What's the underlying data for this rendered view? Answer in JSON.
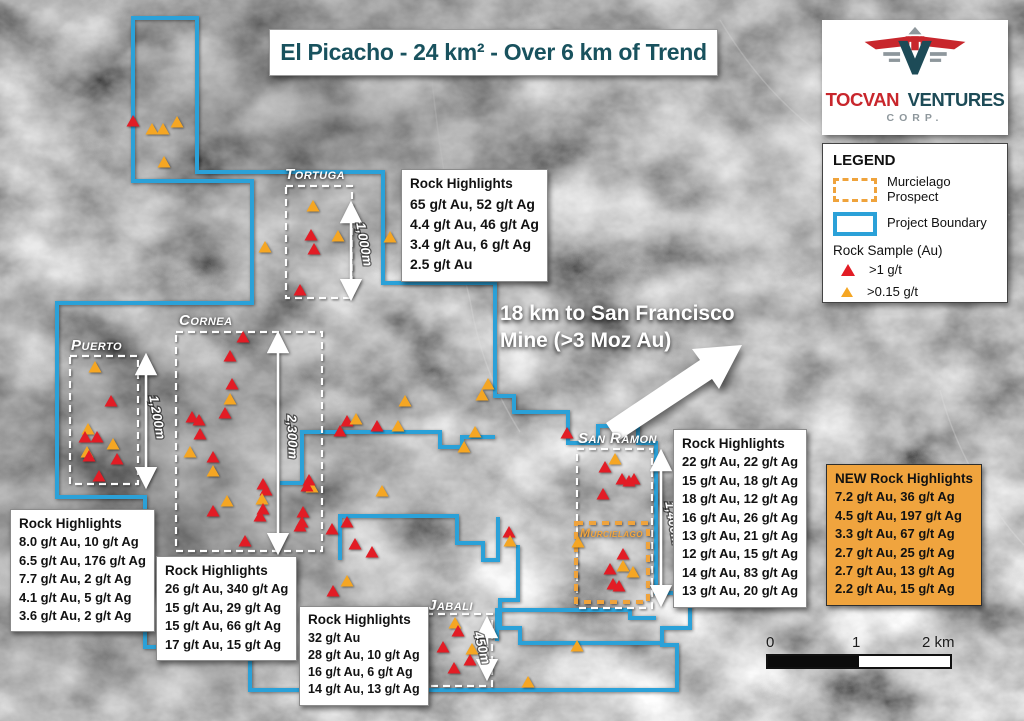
{
  "title": "El Picacho - 24 km² - Over 6 km of Trend",
  "logo": {
    "word1": "TOCVAN",
    "word2": "VENTURES",
    "corp": "CORP."
  },
  "legend": {
    "heading": "LEGEND",
    "murcielago": "Murcielago Prospect",
    "boundary": "Project Boundary",
    "rock_sample": "Rock Sample (Au)",
    "high_grade": ">1 g/t",
    "low_grade": ">0.15 g/t"
  },
  "annotation": {
    "line1": "18 km to San Francisco",
    "line2": "Mine (>3 Moz Au)"
  },
  "scale_bar": {
    "tick0": "0",
    "tick1": "1",
    "tick2": "2 km"
  },
  "zones": {
    "tortuga": {
      "label": "Tortuga",
      "length": "1,000m"
    },
    "cornea": {
      "label": "Cornea",
      "length": "2,300m"
    },
    "puerto": {
      "label": "Puerto",
      "length": "1,200m"
    },
    "san_ramon": {
      "label": "San Ramon",
      "length": "1,400m"
    },
    "murcielago": {
      "label": "Murcielago"
    },
    "jabali": {
      "label": "Jabali",
      "length": "450m"
    }
  },
  "highlights": {
    "tortuga": {
      "title": "Rock Highlights",
      "lines": [
        "65 g/t Au, 52 g/t Ag",
        "4.4 g/t Au, 46 g/t Ag",
        "3.4 g/t Au, 6 g/t Ag",
        "2.5 g/t Au"
      ]
    },
    "puerto": {
      "title": "Rock Highlights",
      "lines": [
        "8.0 g/t Au, 10 g/t Ag",
        "6.5 g/t Au, 176 g/t Ag",
        "7.7 g/t Au, 2 g/t Ag",
        "4.1 g/t Au, 5 g/t Ag",
        "3.6 g/t Au, 2 g/t Ag"
      ]
    },
    "cornea": {
      "title": "Rock Highlights",
      "lines": [
        "26 g/t Au, 340 g/t Ag",
        "15 g/t Au, 29 g/t Ag",
        "15 g/t Au, 66 g/t Ag",
        "17 g/t Au, 15 g/t Ag"
      ]
    },
    "jabali": {
      "title": "Rock Highlights",
      "lines": [
        "32 g/t Au",
        "28 g/t Au, 10 g/t Ag",
        "16 g/t Au, 6 g/t Ag",
        "14 g/t Au, 13 g/t Ag"
      ]
    },
    "san_ramon": {
      "title": "Rock Highlights",
      "lines": [
        "22 g/t Au, 22 g/t Ag",
        "15 g/t Au, 18 g/t Ag",
        "18 g/t Au, 12 g/t Ag",
        "16 g/t Au, 26 g/t Ag",
        "13 g/t Au, 21 g/t Ag",
        "12 g/t Au, 15 g/t Ag",
        "14 g/t Au, 83 g/t Ag",
        "13 g/t Au, 20 g/t Ag"
      ]
    },
    "new": {
      "title": "NEW Rock Highlights",
      "lines": [
        "7.2 g/t Au, 36 g/t Ag",
        "4.5 g/t Au, 197 g/t Ag",
        "3.3 g/t Au, 67 g/t Ag",
        "2.7 g/t Au, 25 g/t Ag",
        "2.7 g/t Au, 13 g/t Ag",
        "2.2 g/t Au, 15 g/t Ag"
      ]
    }
  },
  "map_data": {
    "colors": {
      "boundary": "#2BA1D8",
      "prospect": "#EFA33C",
      "sample_high": "#E21C25",
      "sample_low": "#F5A623",
      "accent_teal": "#19525E",
      "accent_red": "#C8262C",
      "new_box_bg": "#F0A43E"
    },
    "boundary_paths": [
      "M133,18 L197,18 L197,172 L383,172 L383,283 L495,283 L495,396 L514,396 L514,412 L568,412 L568,443 L598,443 L598,426 L638,426 L638,443 L656,443 L656,593 L690,593 L690,628 L662,628 L662,645 L677,645 L677,690 L250,690 L250,647 L145,647 L145,497 L57,497 L57,303 L252,303 L252,181 L133,181 Z",
      "M280,483 L302,483 L302,432 L440,432 L440,447 L462,447 L462,437 L495,437",
      "M340,560 L340,516 L457,516 L457,543 L483,543 L483,560 L498,560 L498,517",
      "M518,545 L518,600 L500,600 L500,628 L520,628 L520,643 L662,643",
      "M497,641 L497,610 L630,610 L630,618 L656,618"
    ],
    "samples": [
      [
        133,
        122,
        "r"
      ],
      [
        152,
        130,
        "o"
      ],
      [
        163,
        130,
        "o"
      ],
      [
        177,
        123,
        "o"
      ],
      [
        164,
        163,
        "o"
      ],
      [
        265,
        248,
        "o"
      ],
      [
        313,
        207,
        "o"
      ],
      [
        311,
        236,
        "r"
      ],
      [
        314,
        250,
        "r"
      ],
      [
        338,
        237,
        "o"
      ],
      [
        300,
        291,
        "r"
      ],
      [
        390,
        238,
        "o"
      ],
      [
        488,
        385,
        "o"
      ],
      [
        482,
        396,
        "o"
      ],
      [
        405,
        402,
        "o"
      ],
      [
        347,
        422,
        "r"
      ],
      [
        356,
        420,
        "o"
      ],
      [
        377,
        427,
        "r"
      ],
      [
        398,
        427,
        "o"
      ],
      [
        340,
        432,
        "r"
      ],
      [
        475,
        433,
        "o"
      ],
      [
        464,
        448,
        "o"
      ],
      [
        567,
        434,
        "r"
      ],
      [
        95,
        368,
        "o"
      ],
      [
        111,
        402,
        "r"
      ],
      [
        88,
        430,
        "o"
      ],
      [
        85,
        438,
        "r"
      ],
      [
        97,
        438,
        "r"
      ],
      [
        113,
        445,
        "o"
      ],
      [
        87,
        453,
        "o"
      ],
      [
        89,
        457,
        "r"
      ],
      [
        117,
        460,
        "r"
      ],
      [
        99,
        477,
        "r"
      ],
      [
        243,
        338,
        "r"
      ],
      [
        230,
        357,
        "r"
      ],
      [
        232,
        385,
        "r"
      ],
      [
        230,
        400,
        "o"
      ],
      [
        225,
        414,
        "r"
      ],
      [
        192,
        418,
        "r"
      ],
      [
        199,
        421,
        "r"
      ],
      [
        200,
        435,
        "r"
      ],
      [
        190,
        453,
        "o"
      ],
      [
        213,
        458,
        "r"
      ],
      [
        213,
        472,
        "o"
      ],
      [
        263,
        485,
        "r"
      ],
      [
        266,
        491,
        "r"
      ],
      [
        262,
        500,
        "o"
      ],
      [
        227,
        502,
        "o"
      ],
      [
        213,
        512,
        "r"
      ],
      [
        263,
        510,
        "r"
      ],
      [
        260,
        517,
        "r"
      ],
      [
        245,
        542,
        "r"
      ],
      [
        312,
        488,
        "o"
      ],
      [
        309,
        481,
        "r"
      ],
      [
        307,
        487,
        "r"
      ],
      [
        382,
        492,
        "o"
      ],
      [
        303,
        513,
        "r"
      ],
      [
        302,
        523,
        "r"
      ],
      [
        300,
        527,
        "r"
      ],
      [
        332,
        530,
        "r"
      ],
      [
        347,
        523,
        "r"
      ],
      [
        355,
        545,
        "r"
      ],
      [
        372,
        553,
        "r"
      ],
      [
        347,
        582,
        "o"
      ],
      [
        333,
        592,
        "r"
      ],
      [
        509,
        533,
        "r"
      ],
      [
        510,
        542,
        "o"
      ],
      [
        615,
        460,
        "o"
      ],
      [
        605,
        468,
        "r"
      ],
      [
        622,
        480,
        "r"
      ],
      [
        629,
        482,
        "r"
      ],
      [
        634,
        480,
        "r"
      ],
      [
        603,
        495,
        "r"
      ],
      [
        578,
        543,
        "o"
      ],
      [
        623,
        555,
        "r"
      ],
      [
        610,
        570,
        "r"
      ],
      [
        623,
        567,
        "o"
      ],
      [
        633,
        573,
        "o"
      ],
      [
        613,
        585,
        "r"
      ],
      [
        619,
        587,
        "r"
      ],
      [
        455,
        624,
        "o"
      ],
      [
        458,
        632,
        "r"
      ],
      [
        443,
        648,
        "r"
      ],
      [
        472,
        650,
        "o"
      ],
      [
        470,
        661,
        "r"
      ],
      [
        454,
        669,
        "r"
      ],
      [
        577,
        647,
        "o"
      ],
      [
        528,
        683,
        "o"
      ]
    ]
  }
}
